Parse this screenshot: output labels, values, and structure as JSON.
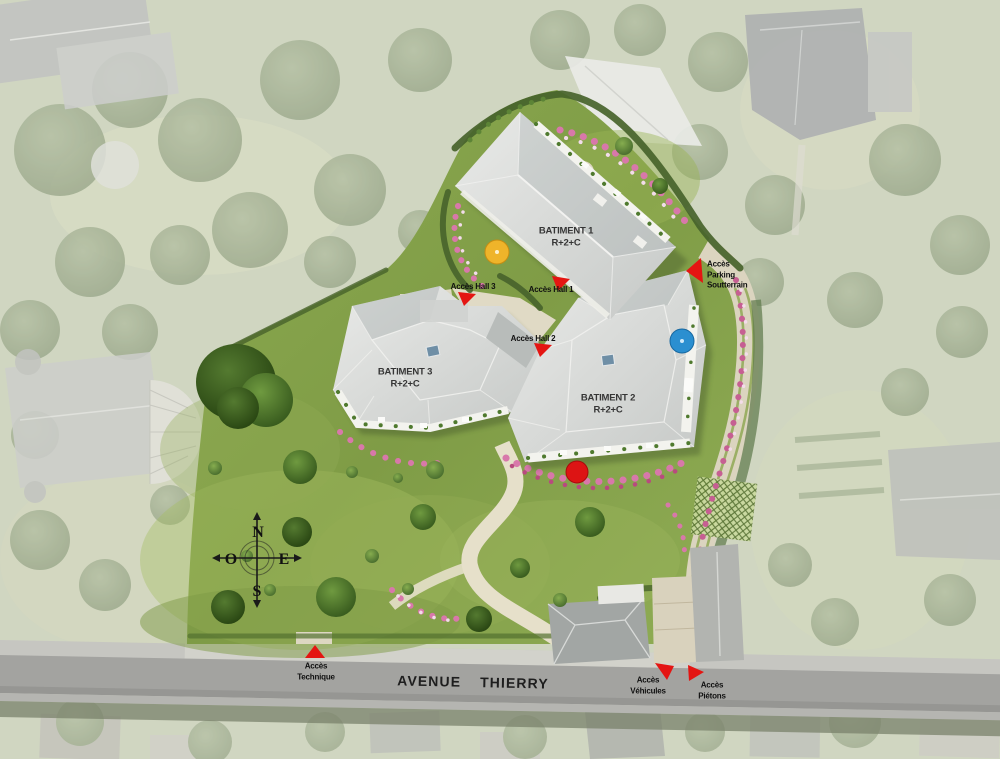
{
  "title": "Plan masse - résidence Avenue Thierry",
  "buildings": {
    "b1": {
      "name": "BATIMENT 1",
      "floors": "R+2+C"
    },
    "b2": {
      "name": "BATIMENT 2",
      "floors": "R+2+C"
    },
    "b3": {
      "name": "BATIMENT 3",
      "floors": "R+2+C"
    }
  },
  "access": {
    "hall1": {
      "label": "Accès Hall 1"
    },
    "hall2": {
      "label": "Accès Hall 2"
    },
    "hall3": {
      "label": "Accès Hall 3"
    },
    "parking": {
      "line1": "Accès",
      "line2": "Parking",
      "line3": "Soutterrain"
    },
    "technique": {
      "line1": "Accès",
      "line2": "Technique"
    },
    "vehicules": {
      "line1": "Accès",
      "line2": "Véhicules"
    },
    "pietons": {
      "line1": "Accès",
      "line2": "Piétons"
    }
  },
  "street": {
    "name": "AVENUE THIERRY"
  },
  "compass": {
    "n": "N",
    "s": "S",
    "e": "E",
    "o": "O"
  },
  "colors": {
    "marker_red": "#e41512",
    "site_green": "#83a04a",
    "roof_gray": "#d6d8d6",
    "road_gray": "#a3a3a0",
    "path_beige": "#e3ddc7",
    "parasol_yellow": "#efb42a",
    "parasol_blue": "#2b8fd0",
    "parasol_red": "#dd1414"
  }
}
